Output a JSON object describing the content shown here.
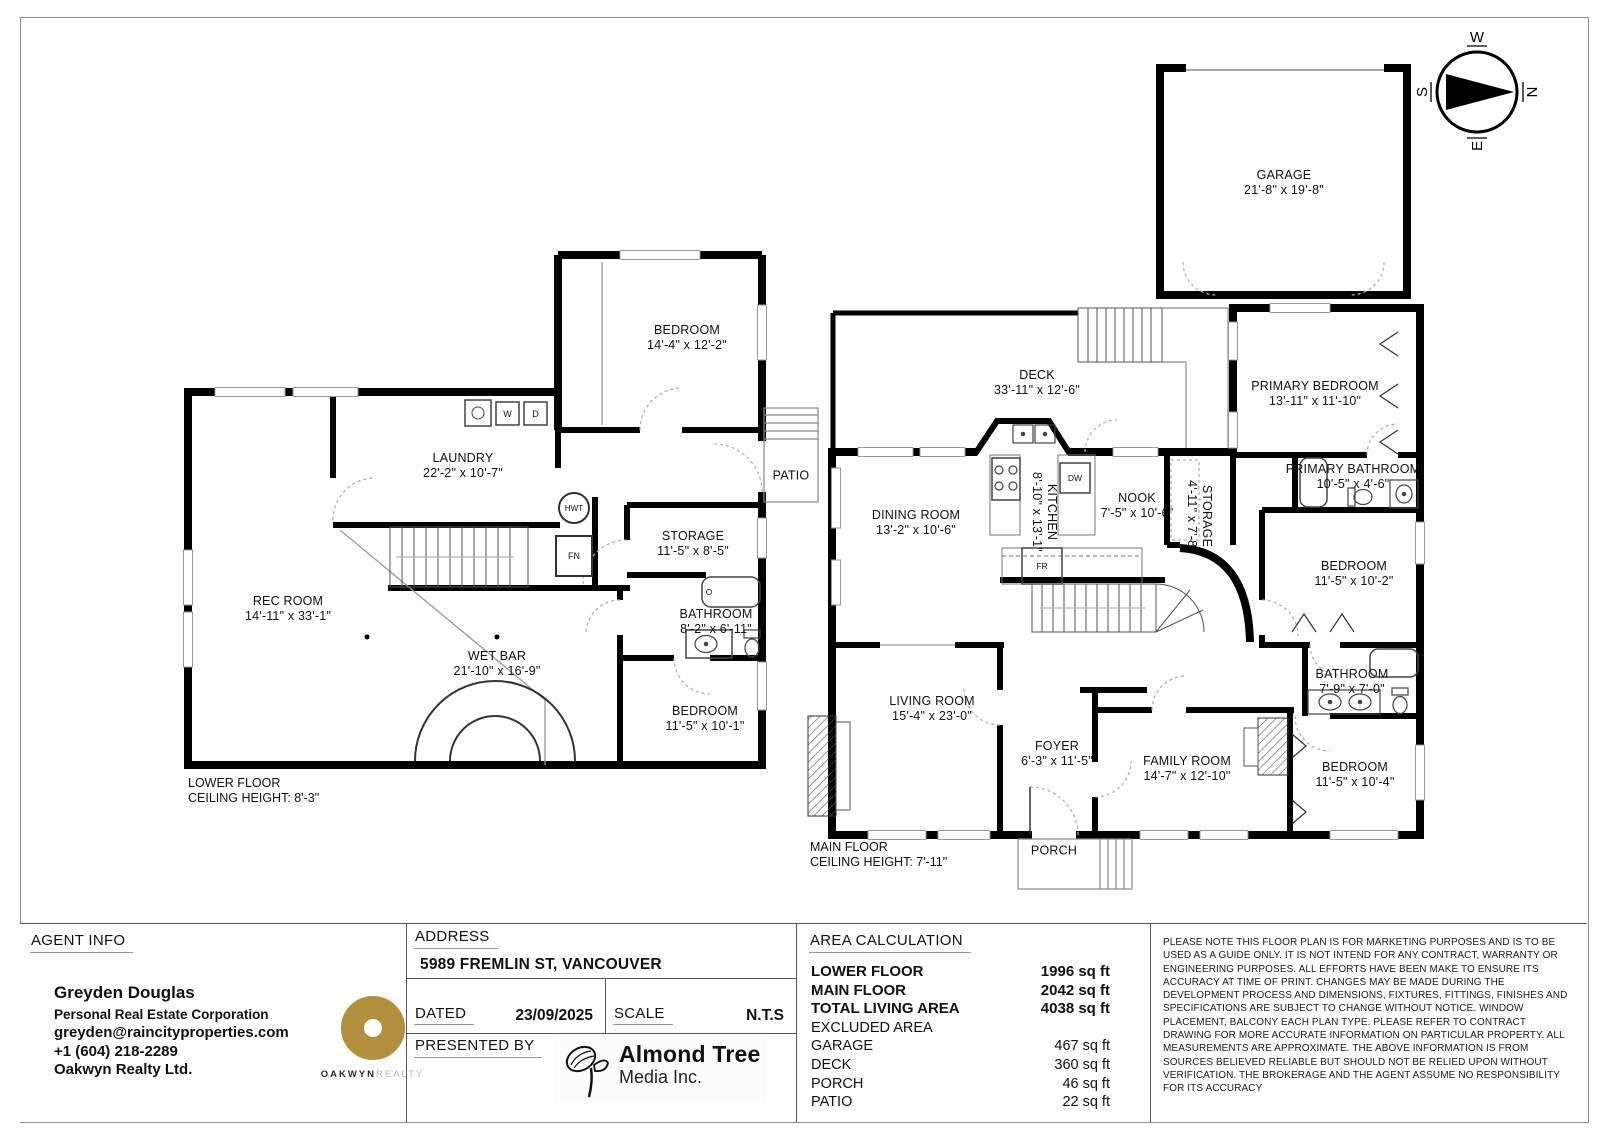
{
  "compass": {
    "n": "N",
    "e": "E",
    "s": "S",
    "w": "W"
  },
  "lower_floor": {
    "floor_label": "LOWER FLOOR",
    "ceiling_label": "CEILING HEIGHT: 8'-3\"",
    "rooms": {
      "bedroom_top": {
        "name": "BEDROOM",
        "dims": "14'-4\" x 12'-2\""
      },
      "laundry": {
        "name": "LAUNDRY",
        "dims": "22'-2\" x 10'-7\""
      },
      "rec_room": {
        "name": "REC ROOM",
        "dims": "14'-11\" x 33'-1\""
      },
      "wet_bar": {
        "name": "WET BAR",
        "dims": "21'-10\" x 16'-9\""
      },
      "storage": {
        "name": "STORAGE",
        "dims": "11'-5\" x 8'-5\""
      },
      "bathroom": {
        "name": "BATHROOM",
        "dims": "8'-2\" x 6'-11\""
      },
      "bedroom_right": {
        "name": "BEDROOM",
        "dims": "11'-5\" x 10'-1\""
      },
      "patio": {
        "name": "PATIO"
      }
    },
    "fixtures": {
      "washer": "W",
      "dryer": "D",
      "hot_water_tank": "HWT",
      "furnace": "FN"
    }
  },
  "main_floor": {
    "floor_label": "MAIN FLOOR",
    "ceiling_label": "CEILING HEIGHT: 7'-11\"",
    "rooms": {
      "garage": {
        "name": "GARAGE",
        "dims": "21'-8\" x 19'-8\""
      },
      "deck": {
        "name": "DECK",
        "dims": "33'-11\" x 12'-6\""
      },
      "dining_room": {
        "name": "DINING ROOM",
        "dims": "13'-2\" x 10'-6\""
      },
      "kitchen": {
        "name": "KITCHEN",
        "dims": "8'-10\" x 13'-1\""
      },
      "nook": {
        "name": "NOOK",
        "dims": "7'-5\" x 10'-6\""
      },
      "storage": {
        "name": "STORAGE",
        "dims": "4'-11\" x 7'-8\""
      },
      "primary_bedroom": {
        "name": "PRIMARY BEDROOM",
        "dims": "13'-11\" x 11'-10\""
      },
      "primary_bathroom": {
        "name": "PRIMARY BATHROOM",
        "dims": "10'-5\" x 4'-6\""
      },
      "bedroom_mid": {
        "name": "BEDROOM",
        "dims": "11'-5\" x 10'-2\""
      },
      "bathroom": {
        "name": "BATHROOM",
        "dims": "7'-9\" x 7'-0\""
      },
      "bedroom_bottom": {
        "name": "BEDROOM",
        "dims": "11'-5\" x 10'-4\""
      },
      "family_room": {
        "name": "FAMILY ROOM",
        "dims": "14'-7\" x 12'-10\""
      },
      "living_room": {
        "name": "LIVING ROOM",
        "dims": "15'-4\" x 23'-0\""
      },
      "foyer": {
        "name": "FOYER",
        "dims": "6'-3\" x 11'-5\""
      },
      "porch": {
        "name": "PORCH"
      }
    },
    "fixtures": {
      "dishwasher": "DW",
      "fridge": "FR"
    }
  },
  "footer": {
    "agent_info": {
      "heading": "AGENT INFO",
      "name": "Greyden Douglas",
      "title": "Personal Real Estate Corporation",
      "email": "greyden@raincityproperties.com",
      "phone": "+1 (604) 218-2289",
      "brokerage": "Oakwyn Realty Ltd.",
      "logo_primary": "OAKWYN",
      "logo_secondary": "REALTY"
    },
    "address": {
      "heading": "ADDRESS",
      "value": "5989 FREMLIN ST, VANCOUVER"
    },
    "dated": {
      "label": "DATED",
      "value": "23/09/2025"
    },
    "scale": {
      "label": "SCALE",
      "value": "N.T.S"
    },
    "presented_by": {
      "label": "PRESENTED BY",
      "company_name": "Almond Tree",
      "company_sub": "Media Inc."
    },
    "area_calculation": {
      "heading": "AREA CALCULATION",
      "rows": [
        {
          "label": "LOWER FLOOR",
          "value": "1996 sq ft"
        },
        {
          "label": "MAIN FLOOR",
          "value": "2042 sq ft"
        },
        {
          "label": "TOTAL LIVING AREA",
          "value": "4038 sq ft"
        },
        {
          "label": "EXCLUDED AREA",
          "value": ""
        },
        {
          "label": "GARAGE",
          "value": "467 sq ft"
        },
        {
          "label": "DECK",
          "value": "360 sq ft"
        },
        {
          "label": "PORCH",
          "value": "46 sq ft"
        },
        {
          "label": "PATIO",
          "value": "22 sq ft"
        }
      ]
    },
    "disclaimer": "PLEASE NOTE THIS FLOOR PLAN IS FOR MARKETING PURPOSES AND IS TO BE USED AS A GUIDE ONLY. IT IS NOT INTEND FOR ANY CONTRACT, WARRANTY OR ENGINEERING PURPOSES. ALL EFFORTS HAVE BEEN MAKE TO ENSURE ITS ACCURACY AT TIME OF PRINT. CHANGES MAY BE MADE DURING THE DEVELOPMENT PROCESS AND DIMENSIONS, FIXTURES, FITTINGS, FINISHES AND SPECIFICATIONS ARE SUBJECT TO CHANGE WITHOUT NOTICE. WINDOW PLACEMENT, BALCONY EACH PLAN TYPE. PLEASE REFER TO CONTRACT DRAWING FOR MORE ACCURATE INFORMATION ON PARTICULAR PROPERTY. ALL MEASUREMENTS ARE APPROXIMATE. THE ABOVE INFORMATION IS FROM SOURCES BELIEVED RELIABLE BUT SHOULD NOT BE RELIED UPON WITHOUT VERIFICATION. THE BROKERAGE AND THE AGENT ASSUME NO RESPONSIBILITY FOR ITS ACCURACY"
  },
  "colors": {
    "brand_gold": "#B2903E",
    "wall_black": "#000000"
  }
}
